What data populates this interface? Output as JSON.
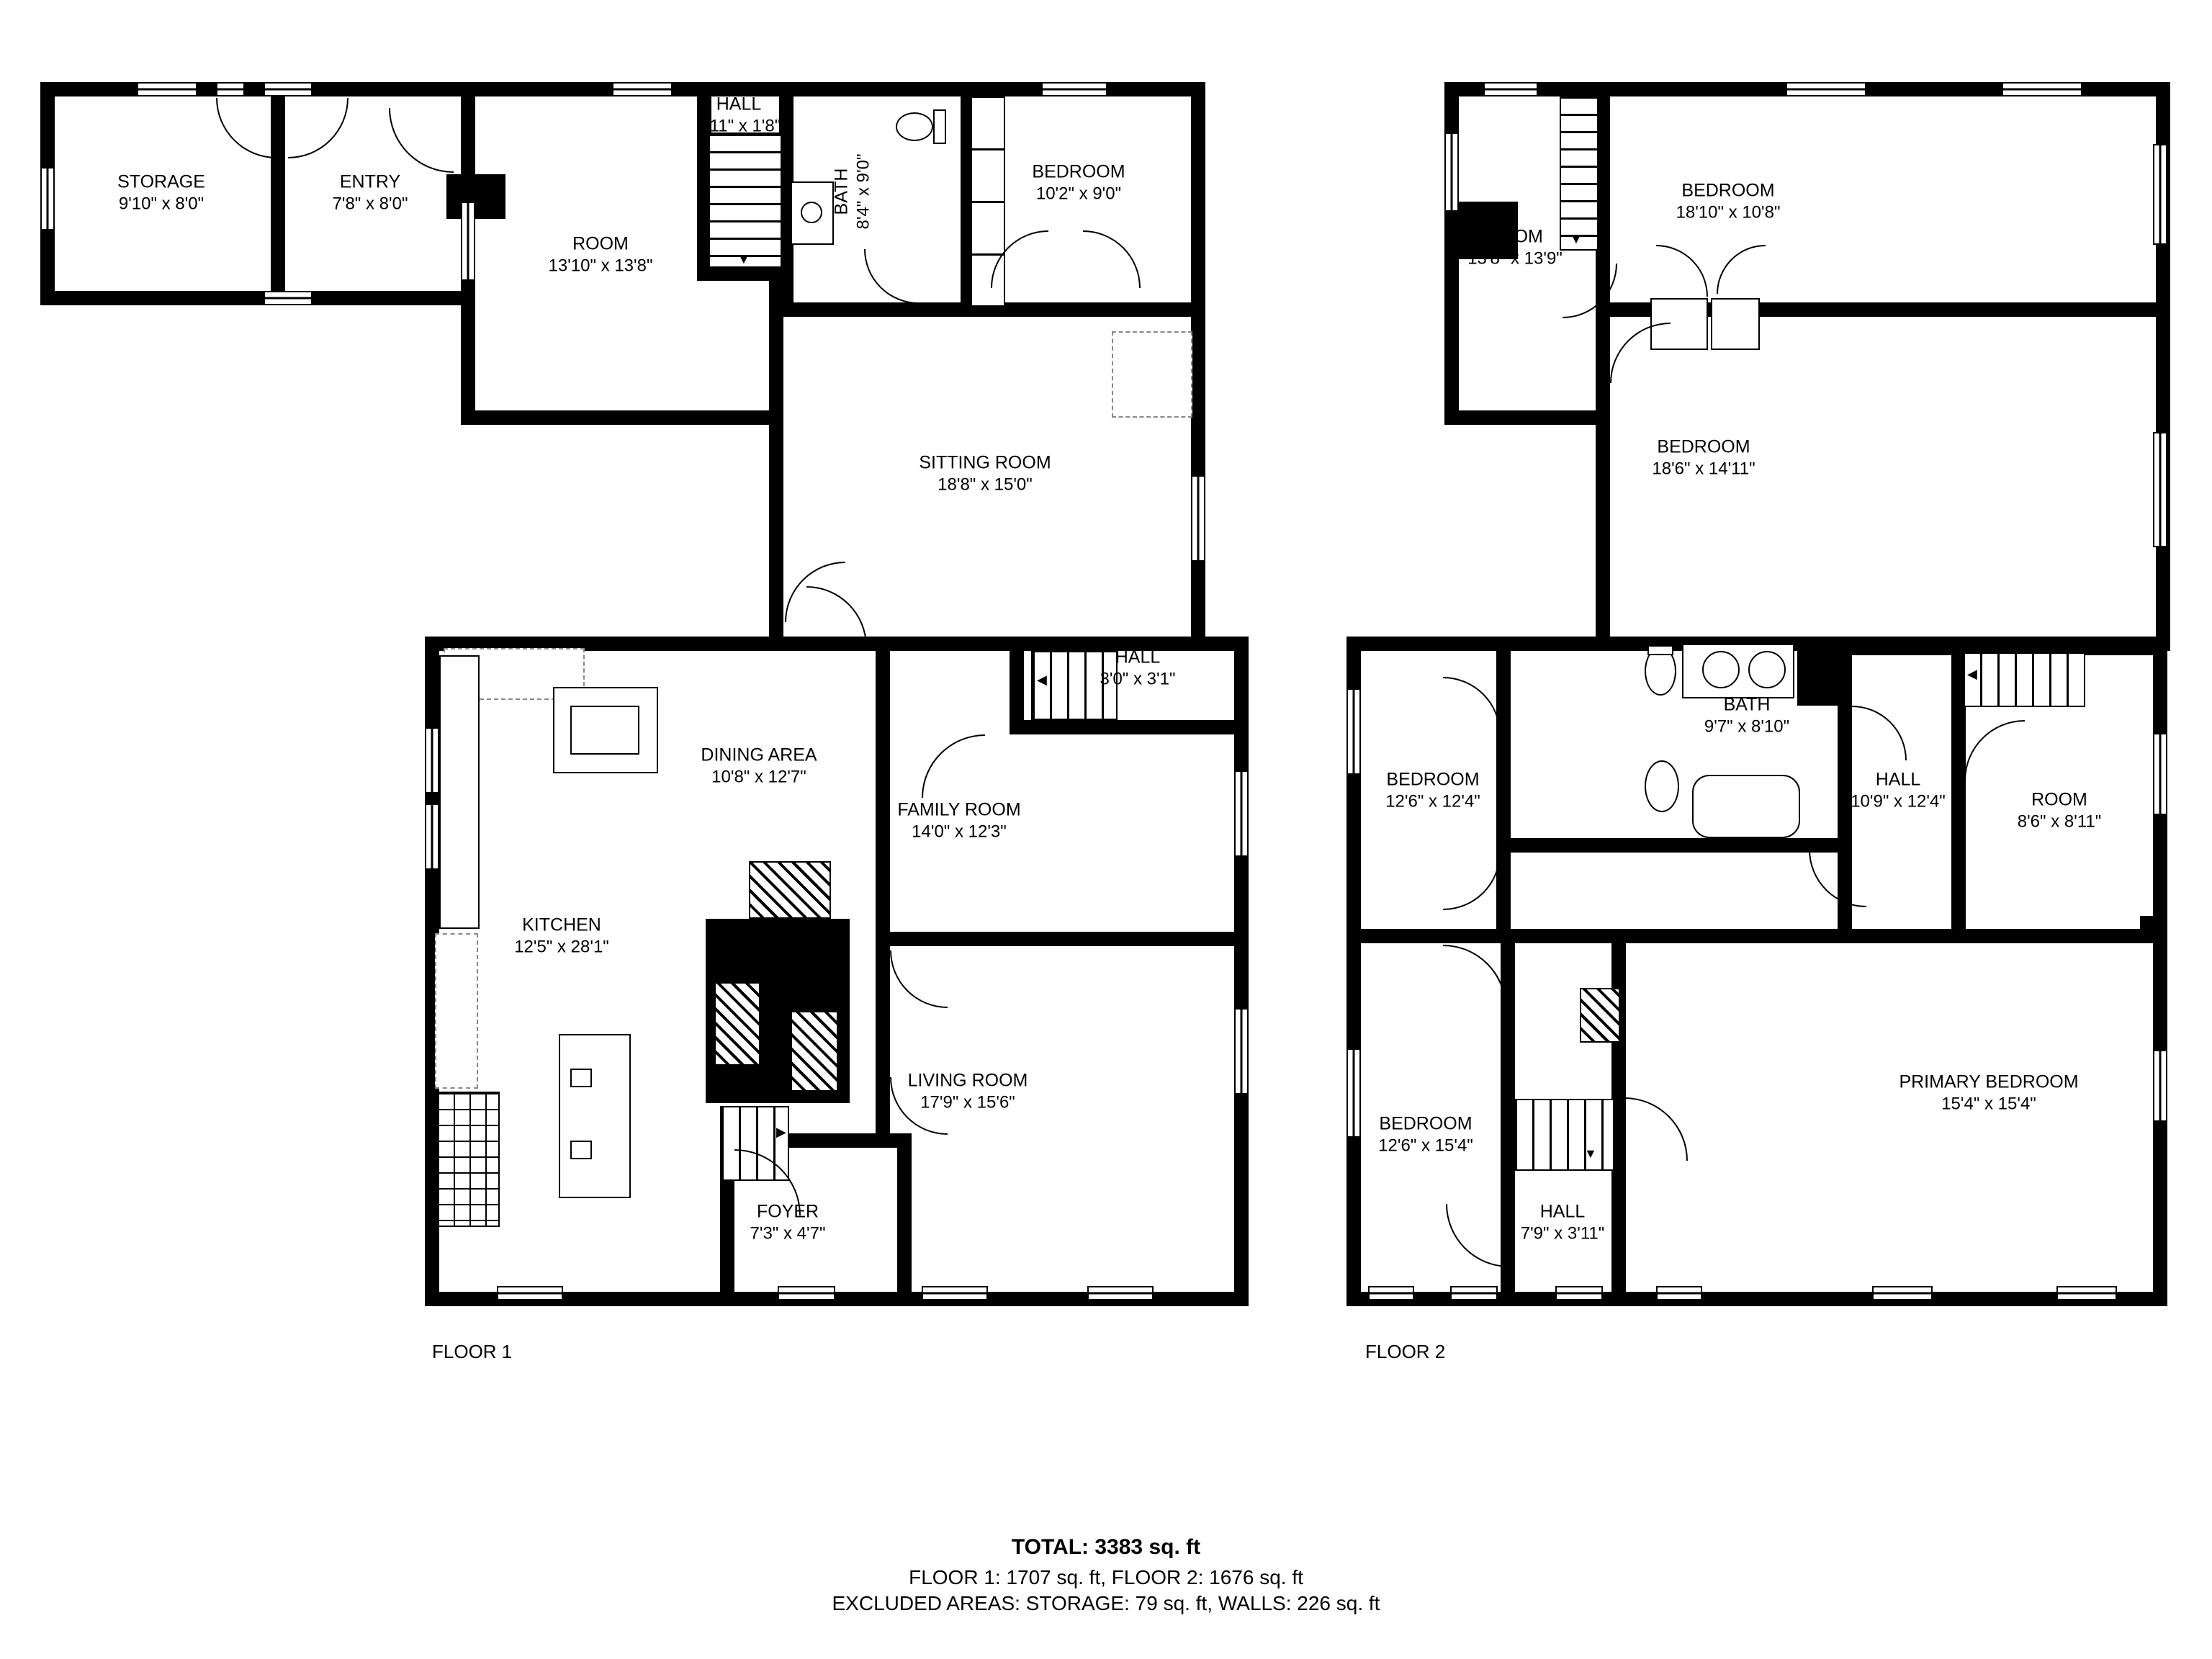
{
  "floor1": {
    "label": "FLOOR 1",
    "rooms": [
      {
        "name": "STORAGE",
        "dims": "9'10\" x 8'0\""
      },
      {
        "name": "ENTRY",
        "dims": "7'8\" x 8'0\""
      },
      {
        "name": "ROOM",
        "dims": "13'10\" x 13'8\""
      },
      {
        "name": "HALL",
        "dims": "2'11\" x 1'8\""
      },
      {
        "name": "BATH",
        "dims": "8'4\" x 9'0\""
      },
      {
        "name": "BEDROOM",
        "dims": "10'2\" x 9'0\""
      },
      {
        "name": "SITTING ROOM",
        "dims": "18'8\" x 15'0\""
      },
      {
        "name": "HALL",
        "dims": "3'0\" x 3'1\""
      },
      {
        "name": "DINING AREA",
        "dims": "10'8\" x 12'7\""
      },
      {
        "name": "FAMILY ROOM",
        "dims": "14'0\" x 12'3\""
      },
      {
        "name": "KITCHEN",
        "dims": "12'5\" x 28'1\""
      },
      {
        "name": "LIVING ROOM",
        "dims": "17'9\" x 15'6\""
      },
      {
        "name": "FOYER",
        "dims": "7'3\" x 4'7\""
      }
    ]
  },
  "floor2": {
    "label": "FLOOR 2",
    "rooms": [
      {
        "name": "ROOM",
        "dims": "13'8\" x 13'9\""
      },
      {
        "name": "BEDROOM",
        "dims": "18'10\" x 10'8\""
      },
      {
        "name": "BEDROOM",
        "dims": "18'6\" x 14'11\""
      },
      {
        "name": "BEDROOM",
        "dims": "12'6\" x 12'4\""
      },
      {
        "name": "BATH",
        "dims": "9'7\" x 8'10\""
      },
      {
        "name": "HALL",
        "dims": "10'9\" x 12'4\""
      },
      {
        "name": "ROOM",
        "dims": "8'6\" x 8'11\""
      },
      {
        "name": "BEDROOM",
        "dims": "12'6\" x 15'4\""
      },
      {
        "name": "HALL",
        "dims": "7'9\" x 3'11\""
      },
      {
        "name": "PRIMARY BEDROOM",
        "dims": "15'4\" x 15'4\""
      }
    ]
  },
  "summary": {
    "total": "TOTAL: 3383 sq. ft",
    "floors": "FLOOR 1: 1707 sq. ft, FLOOR 2: 1676 sq. ft",
    "excluded": "EXCLUDED AREAS: STORAGE: 79 sq. ft, WALLS: 226 sq. ft"
  }
}
